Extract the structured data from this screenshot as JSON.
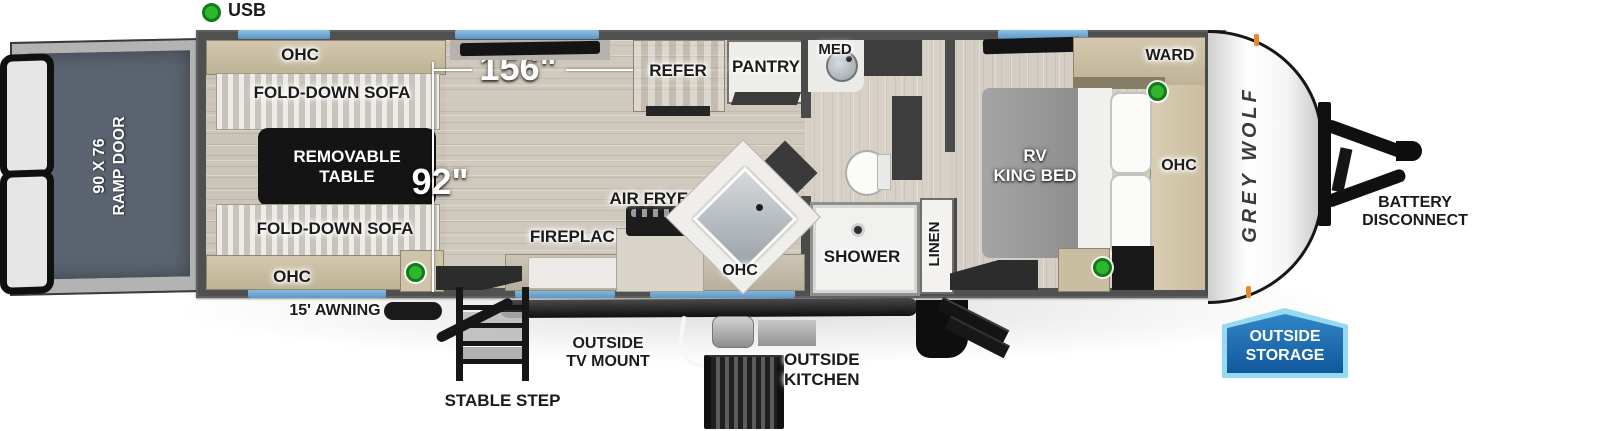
{
  "legend": {
    "usb": "USB"
  },
  "ramp_door": {
    "line1": "90 X 76",
    "line2": "RAMP DOOR"
  },
  "garage": {
    "ohc_top": "OHC",
    "sofa_top": "FOLD-DOWN SOFA",
    "table_line1": "REMOVABLE",
    "table_line2": "TABLE",
    "sofa_bottom": "FOLD-DOWN SOFA",
    "ohc_bottom": "OHC"
  },
  "dimensions": {
    "garage_length": "156\"",
    "garage_width": "92\""
  },
  "kitchen": {
    "refer": "REFER",
    "pantry": "PANTRY",
    "air_fryer": "AIR FRYER",
    "fireplace": "FIREPLACE",
    "ohc": "OHC"
  },
  "bathroom": {
    "med": "MED",
    "shower": "SHOWER",
    "linen": "LINEN"
  },
  "bedroom": {
    "bed_line1": "RV",
    "bed_line2": "KING BED",
    "ward": "WARD",
    "ohc": "OHC"
  },
  "brand": {
    "logo": "GREY WOLF"
  },
  "exterior": {
    "awning": "15' AWNING",
    "stable_step": "STABLE STEP",
    "tv_mount_line1": "OUTSIDE",
    "tv_mount_line2": "TV MOUNT",
    "outside_kitchen_line1": "OUTSIDE",
    "outside_kitchen_line2": "KITCHEN",
    "battery_line1": "BATTERY",
    "battery_line2": "DISCONNECT",
    "storage_line1": "OUTSIDE",
    "storage_line2": "STORAGE"
  },
  "colors": {
    "badge_blue": "#10589c",
    "badge_border": "#96d9f1",
    "window_blue": "#6fa8d4",
    "usb_green": "#2fb52f",
    "marker_orange": "#e8862a"
  }
}
